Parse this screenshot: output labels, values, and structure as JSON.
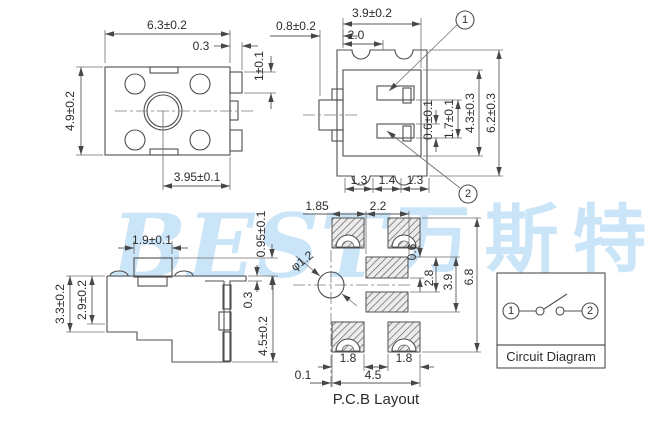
{
  "watermark": {
    "logo_text": "BEST",
    "logo_cjk": "万斯特"
  },
  "top_view": {
    "dim_width": "6.3±0.2",
    "dim_step": "0.3",
    "dim_height": "4.9±0.2",
    "dim_hole_offset": "3.95±0.1",
    "dim_terminal": "1±0.1"
  },
  "gap_dim": "0.8±0.2",
  "front_view": {
    "dim_width": "3.9±0.2",
    "dim_button": "2.0",
    "dim_slot": "0.6±0.1",
    "dim_pitch": "1.7±0.1",
    "dim_body_height": "4.3±0.3",
    "dim_total_height": "6.2±0.3",
    "dim_foot_left": "1.3",
    "dim_foot_mid": "1.4",
    "dim_foot_right": "1.3",
    "pin1": "1",
    "pin2": "2"
  },
  "side_view": {
    "dim_button_width": "1.9±0.1",
    "dim_button_height": "0.95±0.1",
    "dim_body_height": "3.3±0.2",
    "dim_inner_height": "2.9±0.2",
    "dim_step": "0.3",
    "dim_total_height": "4.5±0.2"
  },
  "pcb": {
    "dim_left": "1.85",
    "dim_right": "2.2",
    "dim_hole": "φ1.2",
    "dim_pad_height": "0.6",
    "dim_span_inner": "2.8",
    "dim_span_mid": "3.9",
    "dim_total_height": "6.8",
    "dim_pad_w_left": "1.8",
    "dim_pad_w_right": "1.8",
    "dim_offset": "0.1",
    "dim_width": "4.5",
    "title": "P.C.B Layout"
  },
  "circuit": {
    "pin1": "1",
    "pin2": "2",
    "label": "Circuit Diagram"
  },
  "colors": {
    "line": "#4f4f4f",
    "text": "#2d2d2d",
    "watermark": "#cbe5f8"
  }
}
